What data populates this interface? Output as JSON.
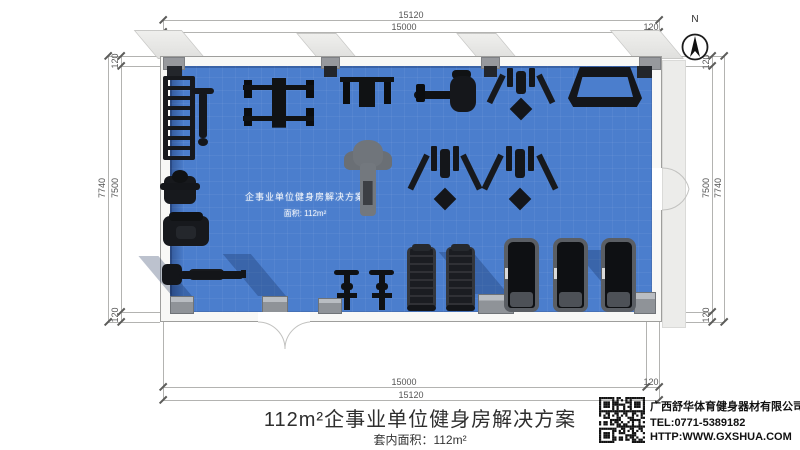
{
  "floor_plan": {
    "dimensions": {
      "width_outer": "15120",
      "width_inner": "15000",
      "height_outer": "7740",
      "height_inner": "7500",
      "wall": "120"
    },
    "compass": {
      "label": "N"
    },
    "watermark": {
      "line1": "企事业单位健身房解决方案",
      "line2": "面积: 112m²"
    },
    "floor_color": "#4b7ecd",
    "equipment": [
      {
        "name": "dumbbell-rack",
        "type": "ladder",
        "x": 163,
        "y": 76,
        "w": 22,
        "h": 84
      },
      {
        "name": "adjustable-bench",
        "type": "tbench",
        "x": 192,
        "y": 88,
        "w": 22,
        "h": 58
      },
      {
        "name": "bench-press-station",
        "type": "station",
        "x": 242,
        "y": 76,
        "w": 74,
        "h": 54
      },
      {
        "name": "weight-bench",
        "type": "station2",
        "x": 340,
        "y": 74,
        "w": 54,
        "h": 36
      },
      {
        "name": "rowing-machine",
        "type": "machine-wide",
        "x": 414,
        "y": 70,
        "w": 62,
        "h": 48
      },
      {
        "name": "multi-press-machine",
        "type": "cable",
        "x": 496,
        "y": 68,
        "w": 50,
        "h": 50
      },
      {
        "name": "squat-rack",
        "type": "trapezoid",
        "x": 568,
        "y": 67,
        "w": 74,
        "h": 40
      },
      {
        "name": "kettlebell-trainer",
        "type": "smallm",
        "x": 164,
        "y": 176,
        "w": 32,
        "h": 28
      },
      {
        "name": "seated-row-machine",
        "type": "machine",
        "x": 163,
        "y": 216,
        "w": 46,
        "h": 30
      },
      {
        "name": "bench-press",
        "type": "benchh",
        "x": 162,
        "y": 261,
        "w": 84,
        "h": 27
      },
      {
        "name": "shoulder-press-machine",
        "type": "gray",
        "x": 344,
        "y": 140,
        "w": 48,
        "h": 78
      },
      {
        "name": "cable-crossover-1",
        "type": "cable",
        "x": 420,
        "y": 146,
        "w": 50,
        "h": 62
      },
      {
        "name": "cable-crossover-2",
        "type": "cable",
        "x": 494,
        "y": 146,
        "w": 52,
        "h": 62
      },
      {
        "name": "spin-bike-1",
        "type": "bike",
        "x": 334,
        "y": 269,
        "w": 25,
        "h": 45
      },
      {
        "name": "spin-bike-2",
        "type": "bike",
        "x": 369,
        "y": 269,
        "w": 25,
        "h": 45
      },
      {
        "name": "stair-climber-1",
        "type": "climber",
        "x": 407,
        "y": 247,
        "w": 23,
        "h": 62
      },
      {
        "name": "stair-climber-2",
        "type": "climber",
        "x": 446,
        "y": 247,
        "w": 23,
        "h": 62
      },
      {
        "name": "treadmill-1",
        "type": "treadmill",
        "x": 504,
        "y": 238,
        "w": 35,
        "h": 74
      },
      {
        "name": "treadmill-2",
        "type": "treadmill",
        "x": 553,
        "y": 238,
        "w": 35,
        "h": 74
      },
      {
        "name": "treadmill-3",
        "type": "treadmill",
        "x": 601,
        "y": 238,
        "w": 35,
        "h": 74
      }
    ]
  },
  "title_block": {
    "title": "112m²企事业单位健身房解决方案",
    "area_label": "套内面积：112m²"
  },
  "company": {
    "name": "广西舒华体育健身器材有限公司",
    "tel": "TEL:0771-5389182",
    "website": "HTTP:WWW.GXSHUA.COM"
  }
}
